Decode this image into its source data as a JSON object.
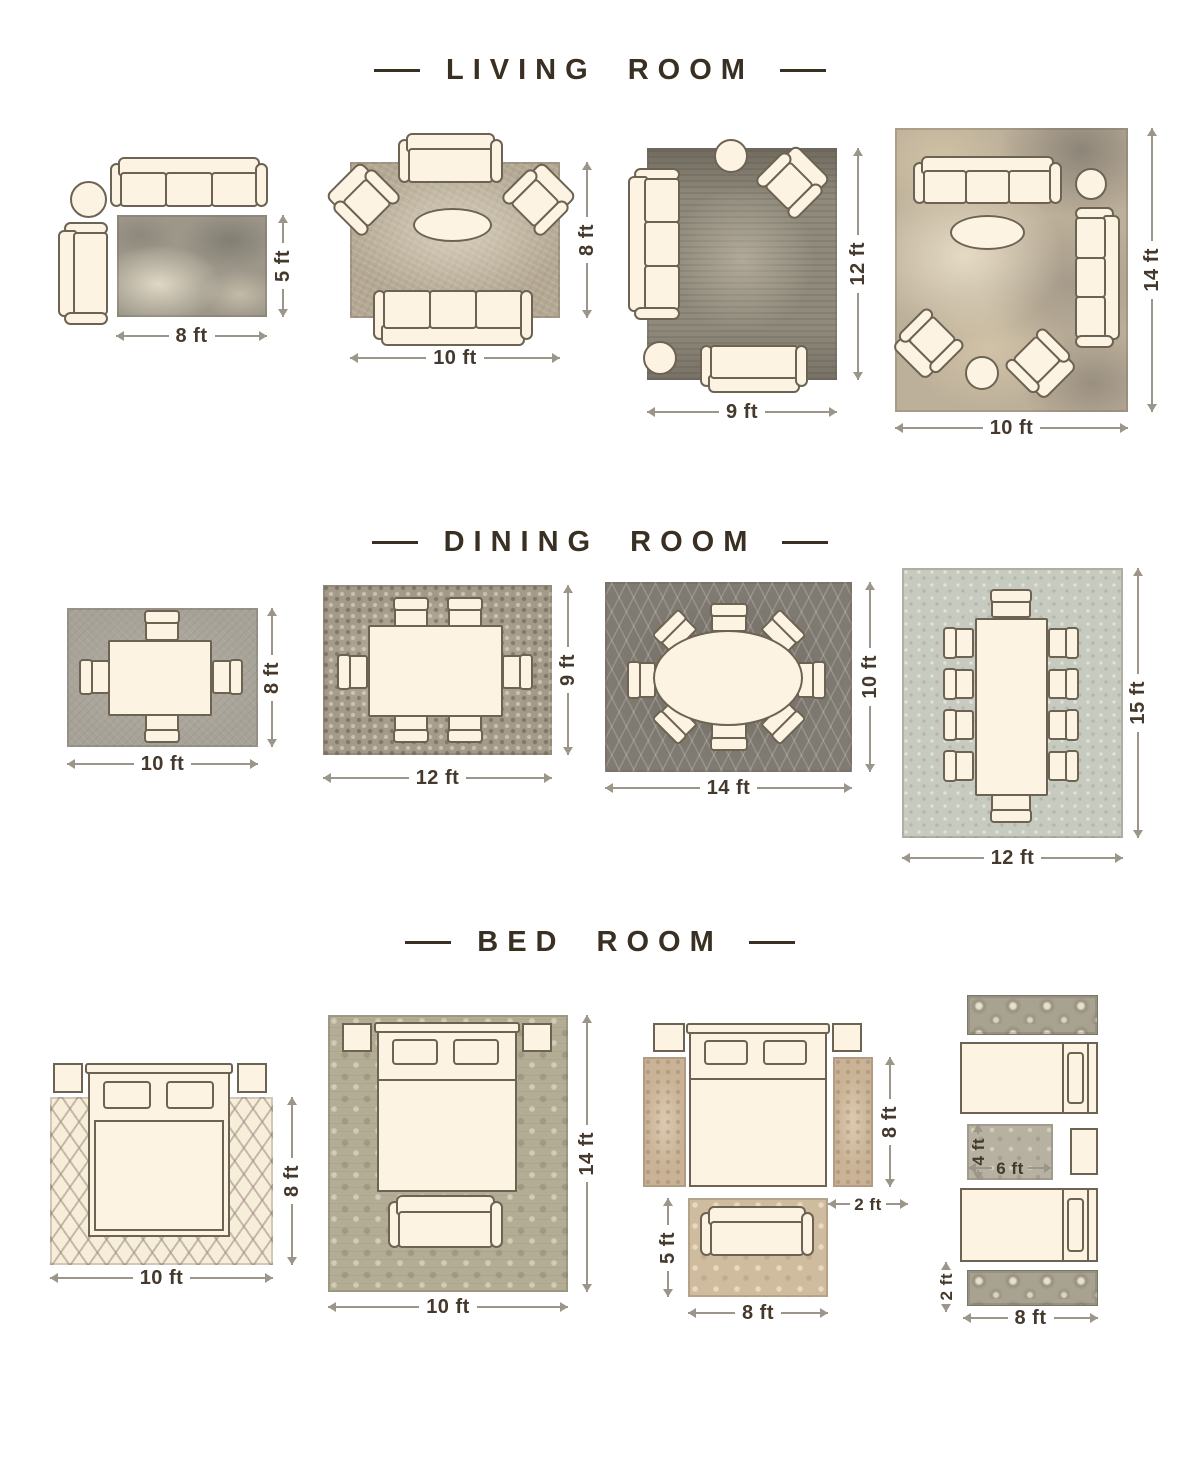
{
  "colors": {
    "title_text": "#3a2f23",
    "dimension_text": "#44392c",
    "dimension_line": "#9c968a",
    "furniture_fill": "#fcf3e2",
    "furniture_outline": "#6d6353"
  },
  "sections": [
    {
      "title": "LIVING ROOM",
      "layouts": [
        {
          "name": "sofa-and-loveseat-corner",
          "rug_width": "8 ft",
          "rug_height": "5 ft",
          "furniture": [
            "3-seat sofa",
            "round side table",
            "loveseat",
            "rug"
          ]
        },
        {
          "name": "sofa-facing-loveseat-with-armchairs",
          "rug_width": "10 ft",
          "rug_height": "8 ft",
          "furniture": [
            "loveseat",
            "2 armchairs",
            "oval coffee table",
            "3-seat sofa",
            "rug"
          ]
        },
        {
          "name": "l-shaped-seating",
          "rug_width": "9 ft",
          "rug_height": "12 ft",
          "furniture": [
            "3-seat sofa",
            "armchair",
            "2 round side tables",
            "loveseat",
            "rug"
          ]
        },
        {
          "name": "full-room-seating",
          "rug_width": "10 ft",
          "rug_height": "14 ft",
          "furniture": [
            "2 sofas",
            "2 armchairs",
            "oval coffee table",
            "2 round side tables",
            "rug"
          ]
        }
      ]
    },
    {
      "title": "DINING ROOM",
      "layouts": [
        {
          "name": "table-with-4-chairs",
          "rug_width": "10 ft",
          "rug_height": "8 ft",
          "furniture": [
            "dining table",
            "4 chairs",
            "rug"
          ]
        },
        {
          "name": "table-with-6-chairs",
          "rug_width": "12 ft",
          "rug_height": "9 ft",
          "furniture": [
            "dining table",
            "6 chairs",
            "rug"
          ]
        },
        {
          "name": "oval-table-with-8-chairs",
          "rug_width": "14 ft",
          "rug_height": "10 ft",
          "furniture": [
            "oval dining table",
            "8 chairs",
            "rug"
          ]
        },
        {
          "name": "long-table-with-10-chairs",
          "rug_width": "12 ft",
          "rug_height": "15 ft",
          "furniture": [
            "dining table",
            "10 chairs",
            "rug"
          ]
        }
      ]
    },
    {
      "title": "BED ROOM",
      "layouts": [
        {
          "name": "bed-front-half-on-rug",
          "rug_width": "10 ft",
          "rug_height": "8 ft",
          "furniture": [
            "queen bed",
            "2 nightstands",
            "rug"
          ]
        },
        {
          "name": "bed-fully-on-rug",
          "rug_width": "10 ft",
          "rug_height": "14 ft",
          "furniture": [
            "queen bed",
            "2 nightstands",
            "bench",
            "rug"
          ]
        },
        {
          "name": "runners-beside-bed-with-foot-rug",
          "runner_length": "8 ft",
          "runner_width": "2 ft",
          "foot_rug_width": "8 ft",
          "foot_rug_height": "5 ft",
          "furniture": [
            "queen bed",
            "2 nightstands",
            "2 runners",
            "loveseat",
            "foot rug"
          ]
        },
        {
          "name": "twin-beds-with-runners",
          "between_rug_width": "6 ft",
          "between_rug_height": "4 ft",
          "runner_width": "2 ft",
          "runner_length": "8 ft",
          "furniture": [
            "2 twin beds",
            "nightstand",
            "2 runners",
            "between-beds rug"
          ]
        }
      ]
    }
  ]
}
